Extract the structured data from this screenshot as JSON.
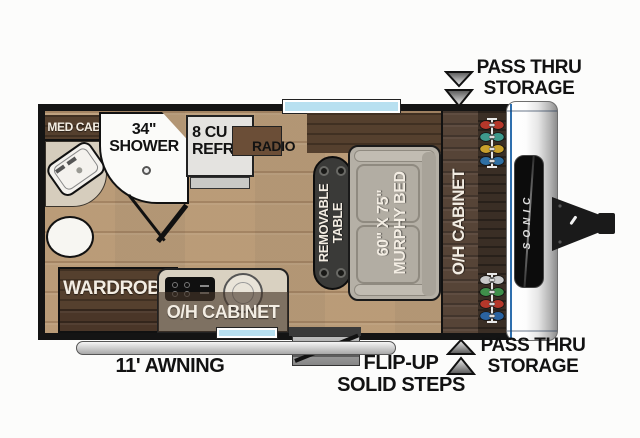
{
  "brand": "SONIC",
  "labels": {
    "med_cab": "MED CAB",
    "shower": [
      "34\"",
      "SHOWER"
    ],
    "refrig": [
      "8 CU FT",
      "REFRIG"
    ],
    "radio": "RADIO",
    "table": [
      "REMOVABLE",
      "TABLE"
    ],
    "murphy_bed": [
      "60\" X 75\"",
      "MURPHY BED"
    ],
    "oh_cabinet_front": "O/H CABINET",
    "wardrobe": "WARDROBE",
    "oh_cabinet_kitchen": "O/H CABINET",
    "awning": "11' AWNING",
    "flip_up_steps": [
      "FLIP-UP",
      "SOLID STEPS"
    ],
    "pass_thru_top": [
      "PASS THRU",
      "STORAGE"
    ],
    "pass_thru_bottom": [
      "PASS THRU",
      "STORAGE"
    ]
  },
  "colors": {
    "wall": "#141414",
    "floor_wood": "#c3a582",
    "dark_cabinet": "#4a3628",
    "window_glass": "#b8e0f0",
    "front_cap_accent": "#2e6fae",
    "label_light": "#f3ede3",
    "label_dark": "#121212"
  },
  "storage_racks": {
    "top": [
      "#b5372a",
      "#3e9a8c",
      "#c9a02c",
      "#2f6fa3"
    ],
    "bottom": [
      "#c9c9c9",
      "#3f8f4a",
      "#b5372a",
      "#2b63a0"
    ]
  }
}
